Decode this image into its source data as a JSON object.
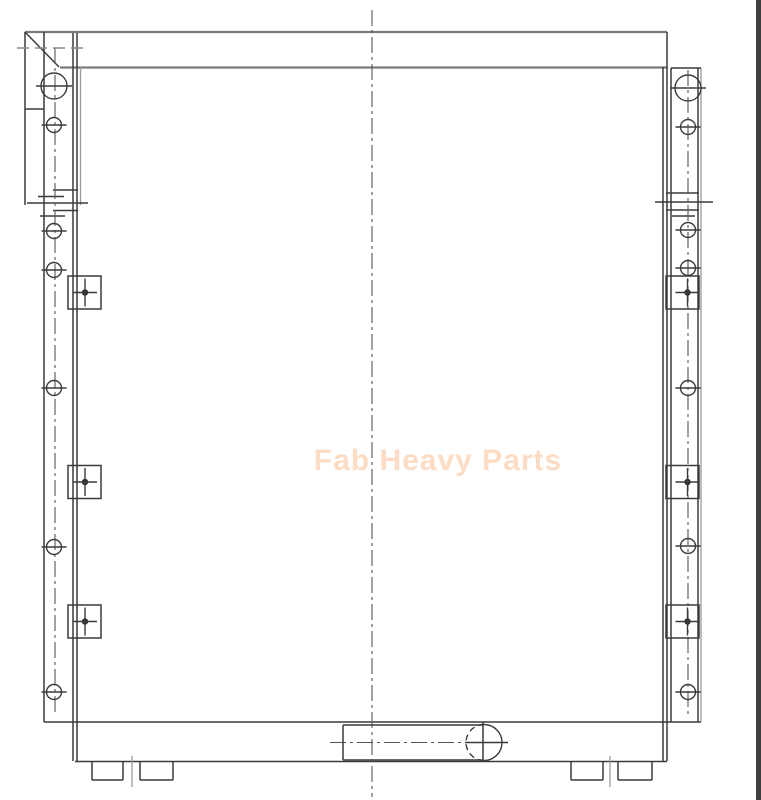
{
  "meta": {
    "view_name": "heavy-equipment-cooler-front-view-drawing",
    "background": "#ffffff"
  },
  "watermark": {
    "text": "Fab Heavy Parts",
    "color": "#fcdcc4"
  },
  "colors": {
    "line_dark": "#3b3b3b",
    "line_gray": "#7a7a7a",
    "line_light": "#9a9a9a",
    "centerline": "#555555",
    "right_bar": "#3f3f3f"
  },
  "drawing": {
    "left_channel_holes": {
      "cx": 54,
      "holes": [
        {
          "cy": 86,
          "r": 13
        },
        {
          "cy": 125,
          "r": 7.5
        },
        {
          "cy": 231,
          "r": 7.5
        },
        {
          "cy": 270,
          "r": 7.5
        },
        {
          "cy": 388,
          "r": 7.5
        },
        {
          "cy": 547,
          "r": 7.5
        },
        {
          "cy": 692,
          "r": 7.5
        }
      ]
    },
    "right_channel_holes": {
      "cx": 688,
      "holes": [
        {
          "cy": 88,
          "r": 13
        },
        {
          "cy": 127,
          "r": 7.5
        },
        {
          "cy": 230,
          "r": 7.5
        },
        {
          "cy": 268,
          "r": 7.5
        },
        {
          "cy": 388,
          "r": 7.5
        },
        {
          "cy": 546,
          "r": 7.5
        },
        {
          "cy": 692,
          "r": 7.5
        }
      ]
    },
    "mounting_pads": {
      "centers_y": [
        292.5,
        482,
        621.5
      ],
      "size": 33,
      "left": {
        "x": 68,
        "target_x": 85
      },
      "right": {
        "x": 666,
        "target_x": 687.5
      }
    },
    "feet": {
      "y": 762,
      "h": 18,
      "boxes": [
        {
          "x": 92,
          "w": 31
        },
        {
          "x": 140,
          "w": 33
        },
        {
          "x": 571,
          "w": 32
        },
        {
          "x": 618,
          "w": 34
        }
      ],
      "center_ticks": [
        132,
        610
      ]
    },
    "drain_plug": {
      "rect": {
        "x1": 343,
        "y1": 725,
        "x2": 483,
        "y2": 760
      },
      "circle": {
        "cx": 484,
        "cy": 742.5,
        "r": 18
      }
    }
  }
}
